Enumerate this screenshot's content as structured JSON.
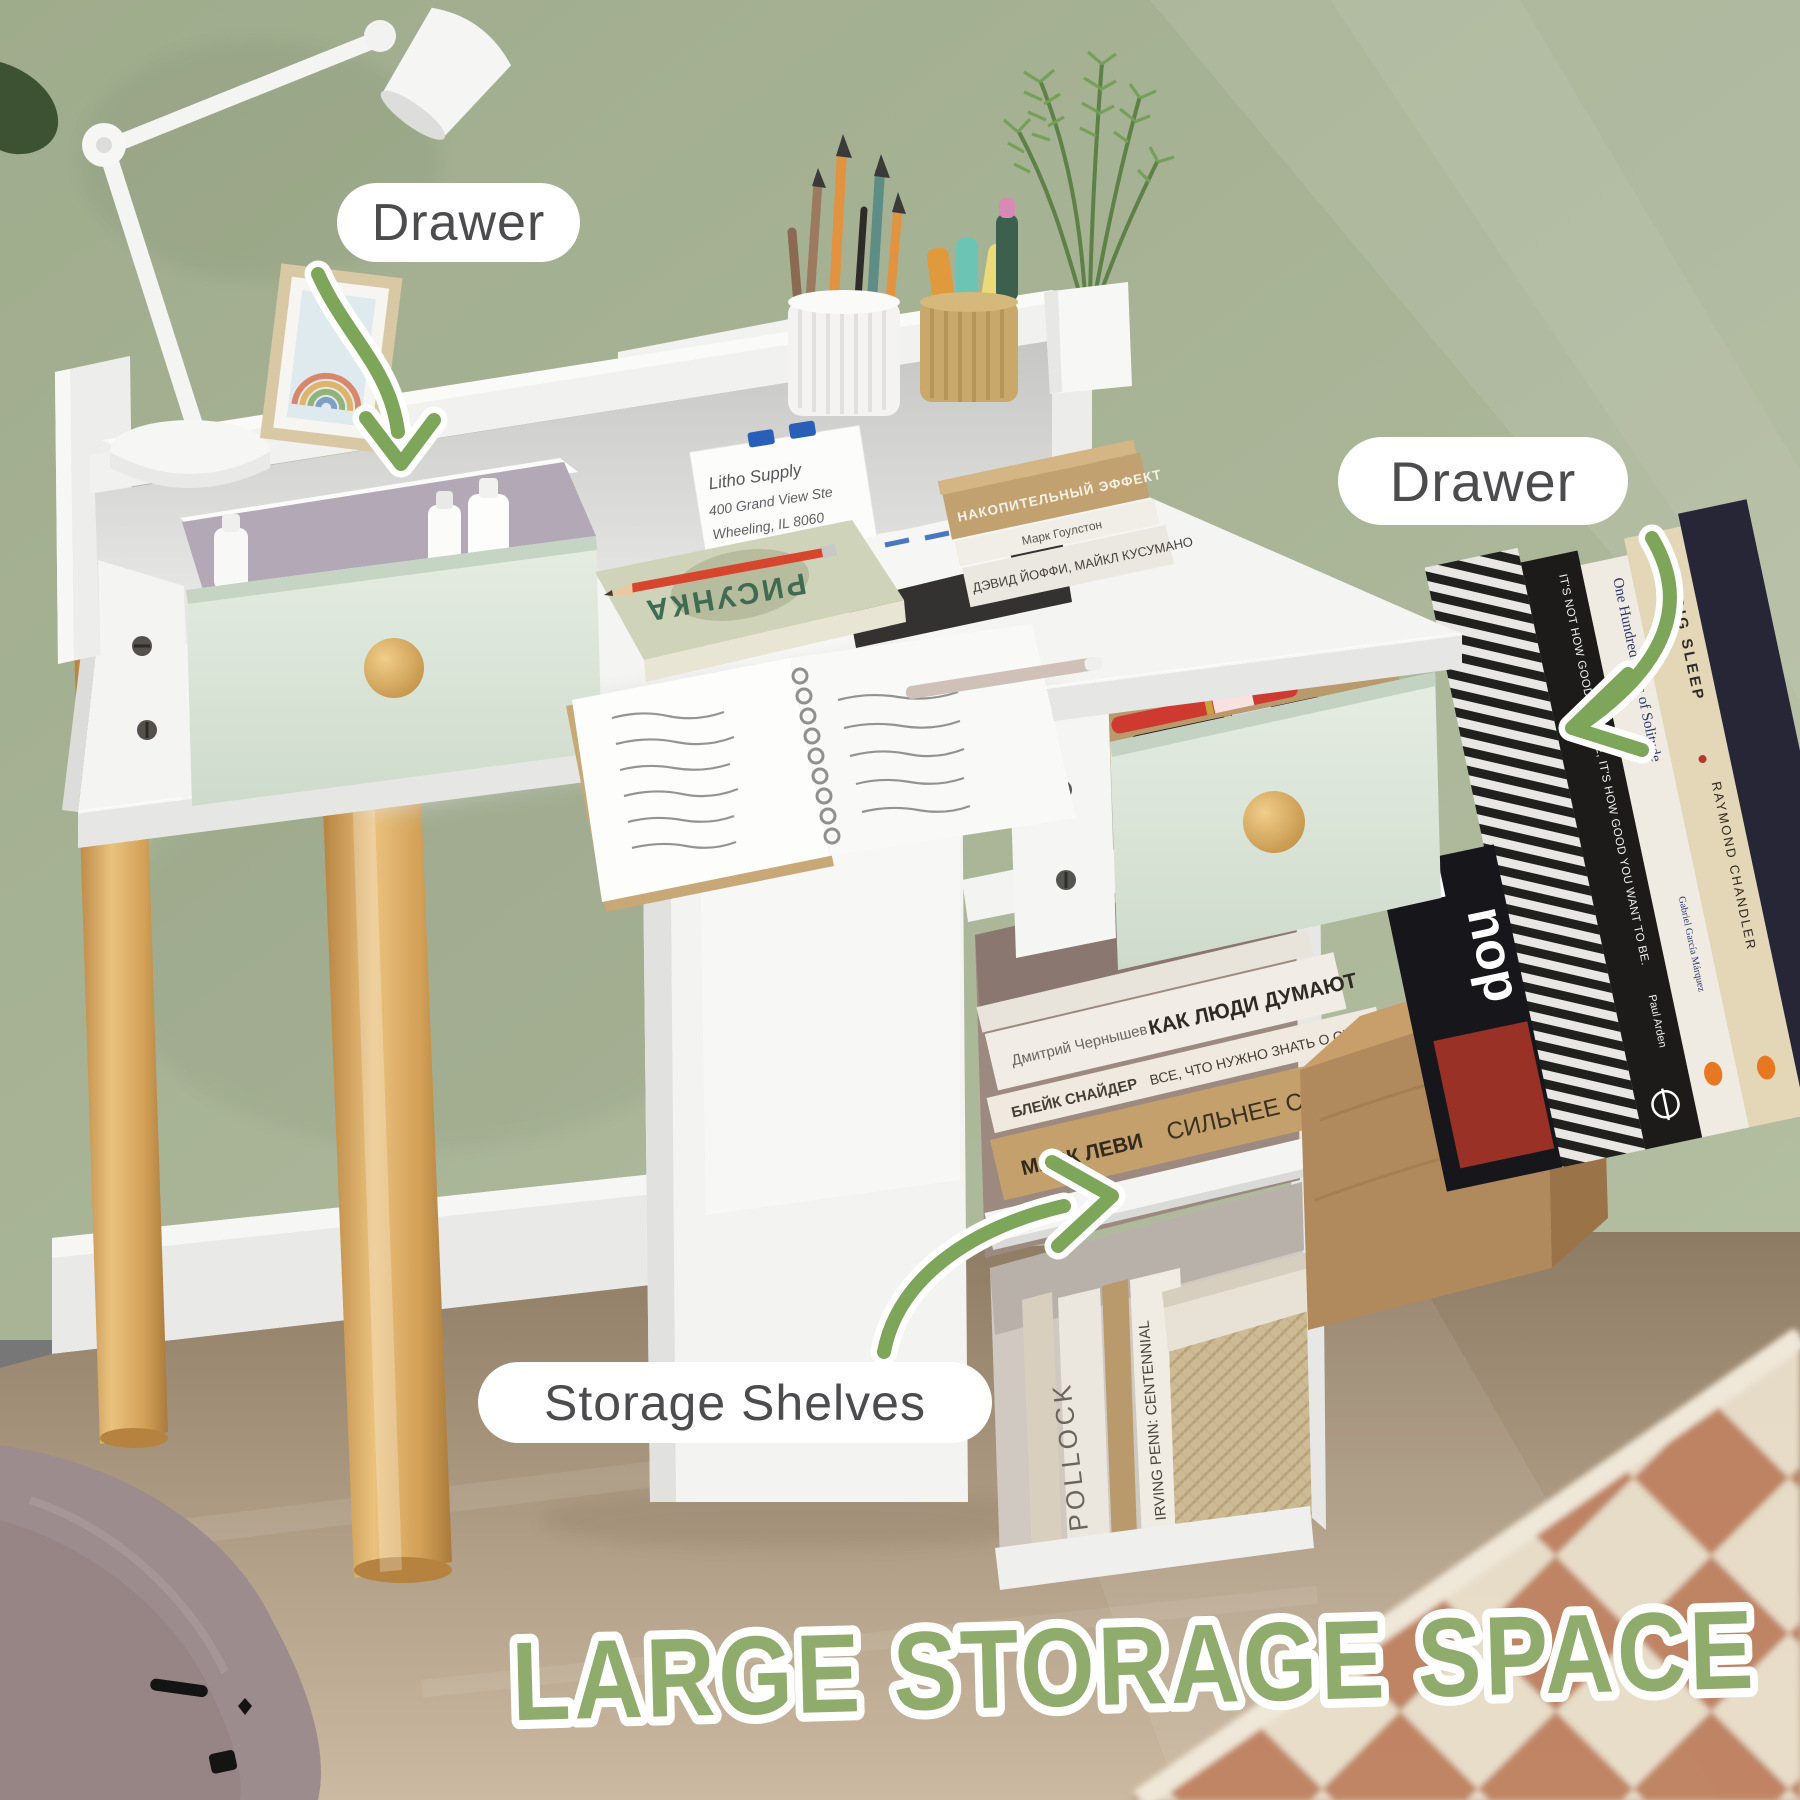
{
  "scene": {
    "type": "furniture-product-photo",
    "labels": {
      "drawer_top": "Drawer",
      "drawer_right": "Drawer",
      "storage_shelves": "Storage Shelves"
    },
    "title": "LARGE STORAGE SPACE",
    "note_card": {
      "line1": "Litho Supply",
      "line2": "400 Grand View Ste",
      "line3": "Wheeling, IL 8060"
    },
    "books": {
      "hutch_stack": [
        "НАКОПИТЕЛЬНЫЙ ЭФФЕКТ",
        "Марк Гоулстон",
        "ДЭВИД ЙОФФИ, МАЙКЛ КУСУМАНО"
      ],
      "open_book_title": "РИСУНКА",
      "shelf_stack": [
        {
          "author": "Дмитрий Чернышев",
          "title": "КАК ЛЮДИ ДУМАЮТ"
        },
        {
          "author": "БЛЕЙК СНАЙДЕР",
          "title": "ВСЕ, ЧТО НУЖНО ЗНАТЬ О СЦЕНАРИИ"
        },
        {
          "author": "МАРК ЛЕВИ",
          "title": "СИЛЬНЕЕ СТРАХА"
        }
      ],
      "bottom_shelf": [
        "POLLOCK",
        "IRVING PENN: CENTENNIAL"
      ],
      "right_stack": [
        {
          "title": "IT'S NOT HOW GOOD YOU ARE, IT'S HOW GOOD YOU WANT TO BE.",
          "author": "Paul Arden"
        },
        {
          "title": "One Hundred Years of Solitude",
          "author": "Gabriel García Márquez"
        },
        {
          "title": "THE BIG SLEEP",
          "author": "RAYMOND CHANDLER"
        }
      ],
      "magazine_fragments": [
        "NEED",
        "nop"
      ]
    },
    "colors": {
      "wall": "#a9b497",
      "arrow_green": "#7da65b",
      "title_green": "#8fac6d",
      "label_text": "#4c4c4f",
      "drawer_sage": "#dde7da",
      "wood": "#d9a85c",
      "floor": "#a8957c",
      "rug_terracotta": "#c08262",
      "rug_cream": "#e9dfca"
    }
  }
}
